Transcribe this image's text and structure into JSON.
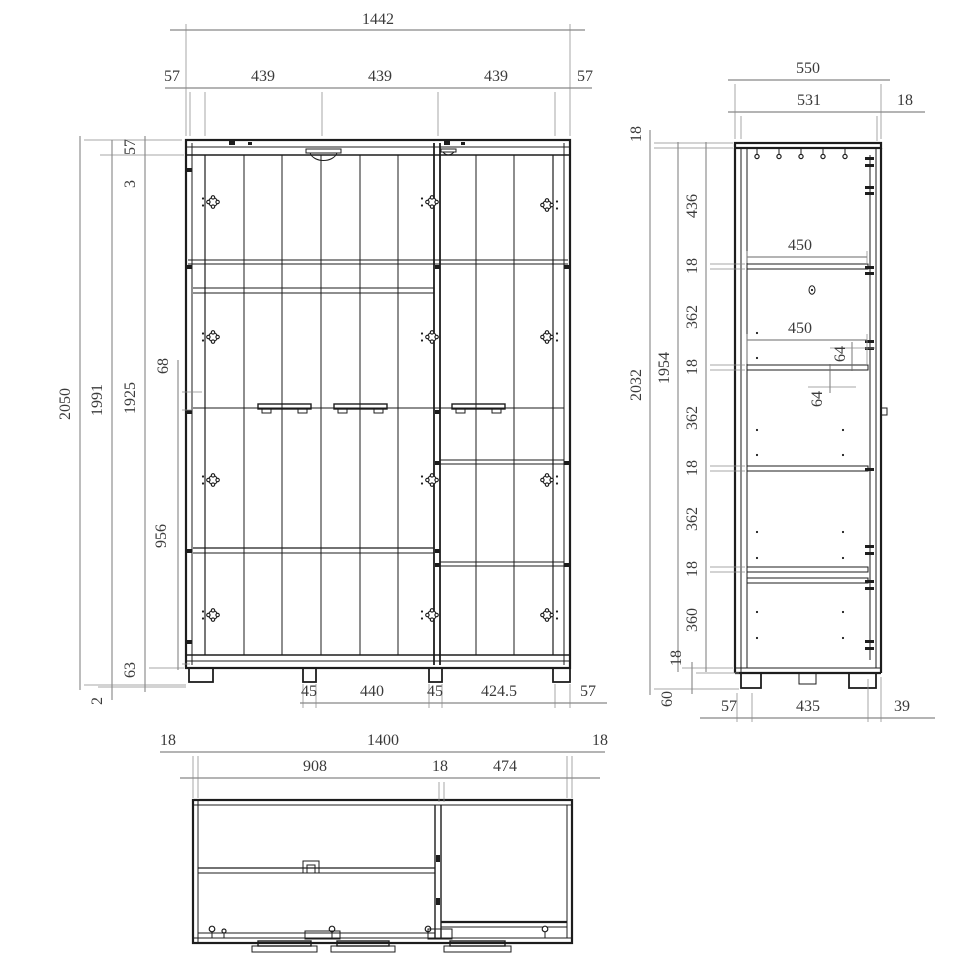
{
  "drawing": {
    "type": "furniture-cad-technical-drawing",
    "colors": {
      "line": "#1d1d1d",
      "dim_line": "#6a6a6a",
      "text": "#3b3b3b",
      "background": "#ffffff"
    },
    "front": {
      "width_total": "1442",
      "side_l": "57",
      "bay1": "439",
      "bay2": "439",
      "bay3": "439",
      "side_r": "57",
      "top_57": "57",
      "gap_3": "3",
      "h_2050": "2050",
      "h_1991": "1991",
      "h_1925": "1925",
      "handle_68": "68",
      "lower_956": "956",
      "plinth_63": "63",
      "gap_2": "2",
      "foot_45l": "45",
      "span_440": "440",
      "foot_45r": "45",
      "door_4245": "424.5",
      "edge_57": "57"
    },
    "side": {
      "depth_550": "550",
      "depth_531": "531",
      "back_18": "18",
      "top_18": "18",
      "h_2032": "2032",
      "h_1954": "1954",
      "seg1_436": "436",
      "seg2_18": "18",
      "seg3_362": "362",
      "seg4_18": "18",
      "seg5_362": "362",
      "seg6_18": "18",
      "seg7_362": "362",
      "seg8_18": "18",
      "seg9_360": "360",
      "shelf_450a": "450",
      "shelf_450b": "450",
      "rail_64a": "64",
      "rail_64b": "64",
      "bottom_18": "18",
      "leg_60": "60",
      "b_57": "57",
      "b_435": "435",
      "b_39": "39"
    },
    "topview": {
      "edge_18l": "18",
      "width_1400": "1400",
      "edge_18r": "18",
      "bay_908": "908",
      "div_18": "18",
      "bay_474": "474"
    }
  }
}
